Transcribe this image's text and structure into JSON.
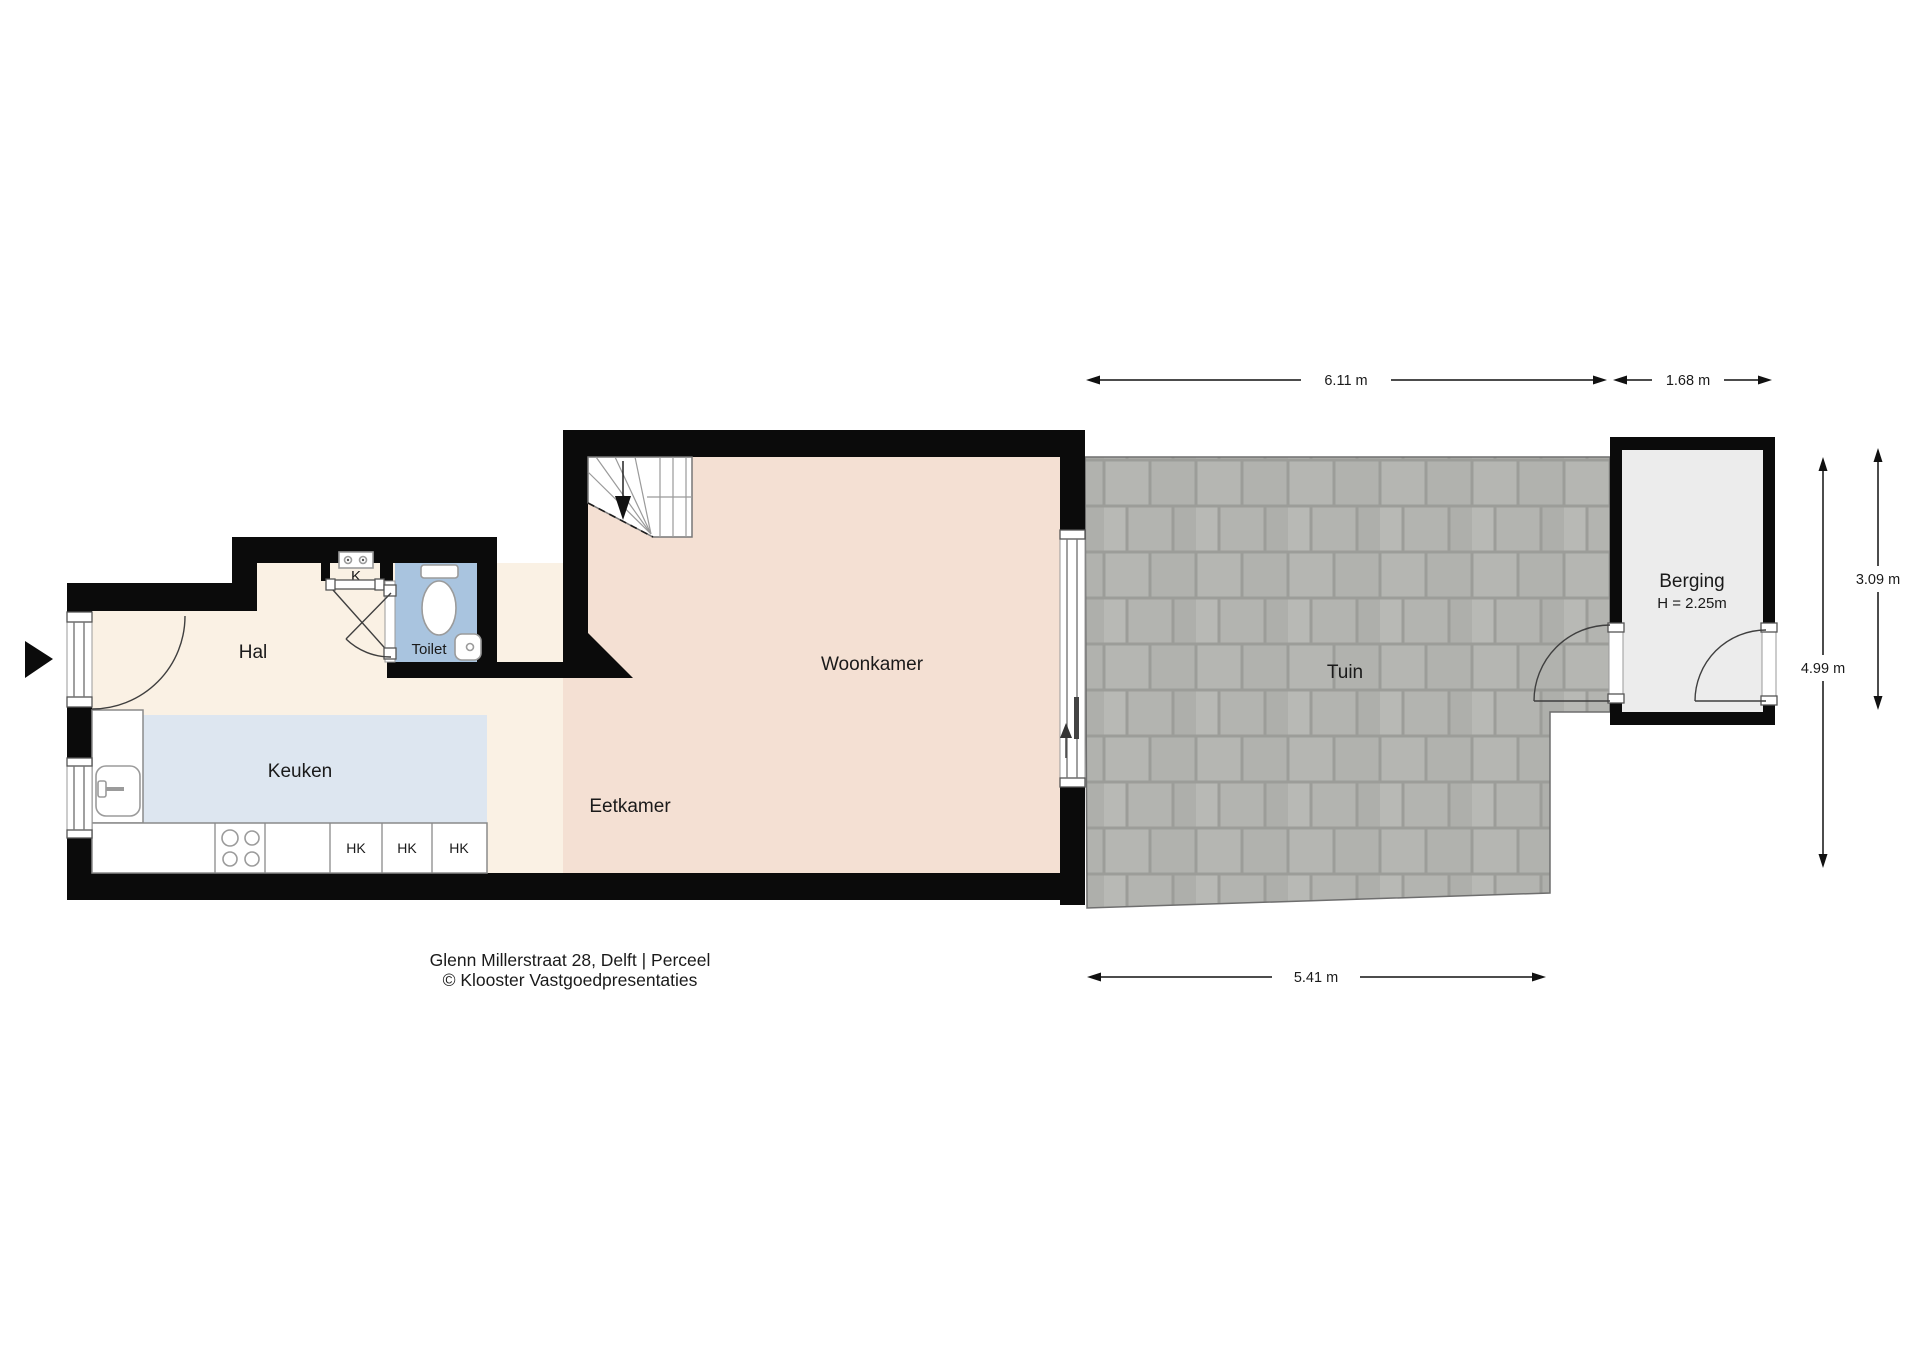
{
  "title_block": {
    "address": "Glenn Millerstraat 28, Delft  | Perceel",
    "credit": "© Klooster Vastgoedpresentaties"
  },
  "rooms": {
    "hal": "Hal",
    "toilet": "Toilet",
    "meter_closet": "K",
    "keuken": "Keuken",
    "eetkamer": "Eetkamer",
    "woonkamer": "Woonkamer",
    "tuin": "Tuin",
    "berging": "Berging",
    "berging_ceiling_height": "H = 2.25m"
  },
  "kitchen_cabinets": [
    "HK",
    "HK",
    "HK"
  ],
  "dimensions": {
    "garden_width": "6.11 m",
    "berging_width": "1.68 m",
    "berging_depth": "3.09 m",
    "garden_depth": "4.99 m",
    "garden_bottom_width": "5.41 m"
  },
  "icons": {
    "entrance_arrow": "solid right-pointing triangle",
    "stairs_direction_arrow": "down arrow along winder stairs",
    "slider_direction_arrow": "up arrow at sliding door"
  },
  "colors": {
    "wall": "#0b0b0b",
    "hal_floor": "#faf1e4",
    "living_floor": "#f4e0d3",
    "kitchen_zone": "#dde6f0",
    "toilet_floor": "#a9c4df",
    "berging_floor": "#ececec",
    "tile": "#b5b6b2",
    "tile_grout": "#9c9d99"
  }
}
